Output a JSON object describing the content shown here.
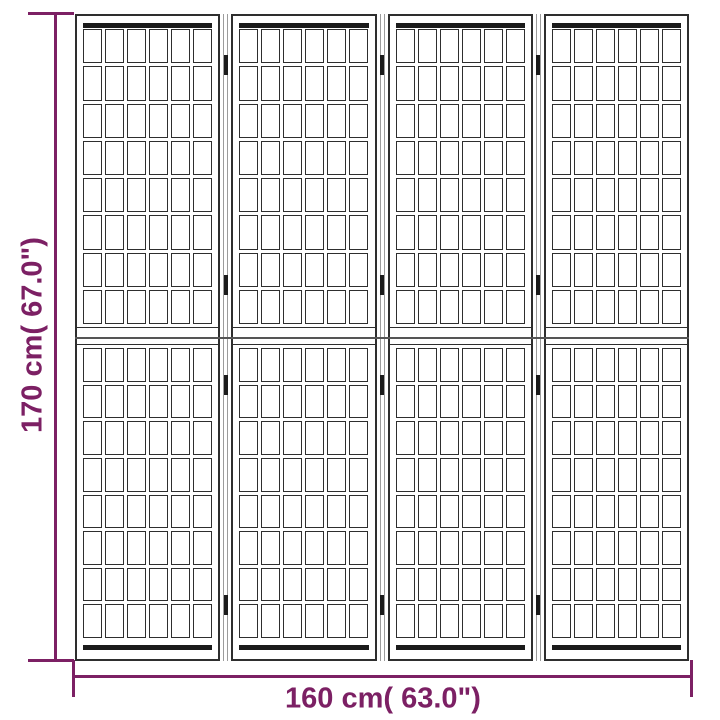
{
  "diagram": {
    "height_label": "170 cm( 67.0\")",
    "width_label": "160 cm( 63.0\")",
    "accent_color": "#7c2064"
  },
  "screen": {
    "panel_count": 4,
    "sections_per_panel": 2,
    "lattice_columns_per_panel": 6,
    "lattice_rows_per_section": 8,
    "hinges_per_joint": 4,
    "frame_color": "#2e2e2e",
    "rail_bar_color": "#1b1b1b",
    "joint_strip_color": "#9c9c9c",
    "hinge_color": "#1b1b1b",
    "center_joint_color": "#555555"
  }
}
